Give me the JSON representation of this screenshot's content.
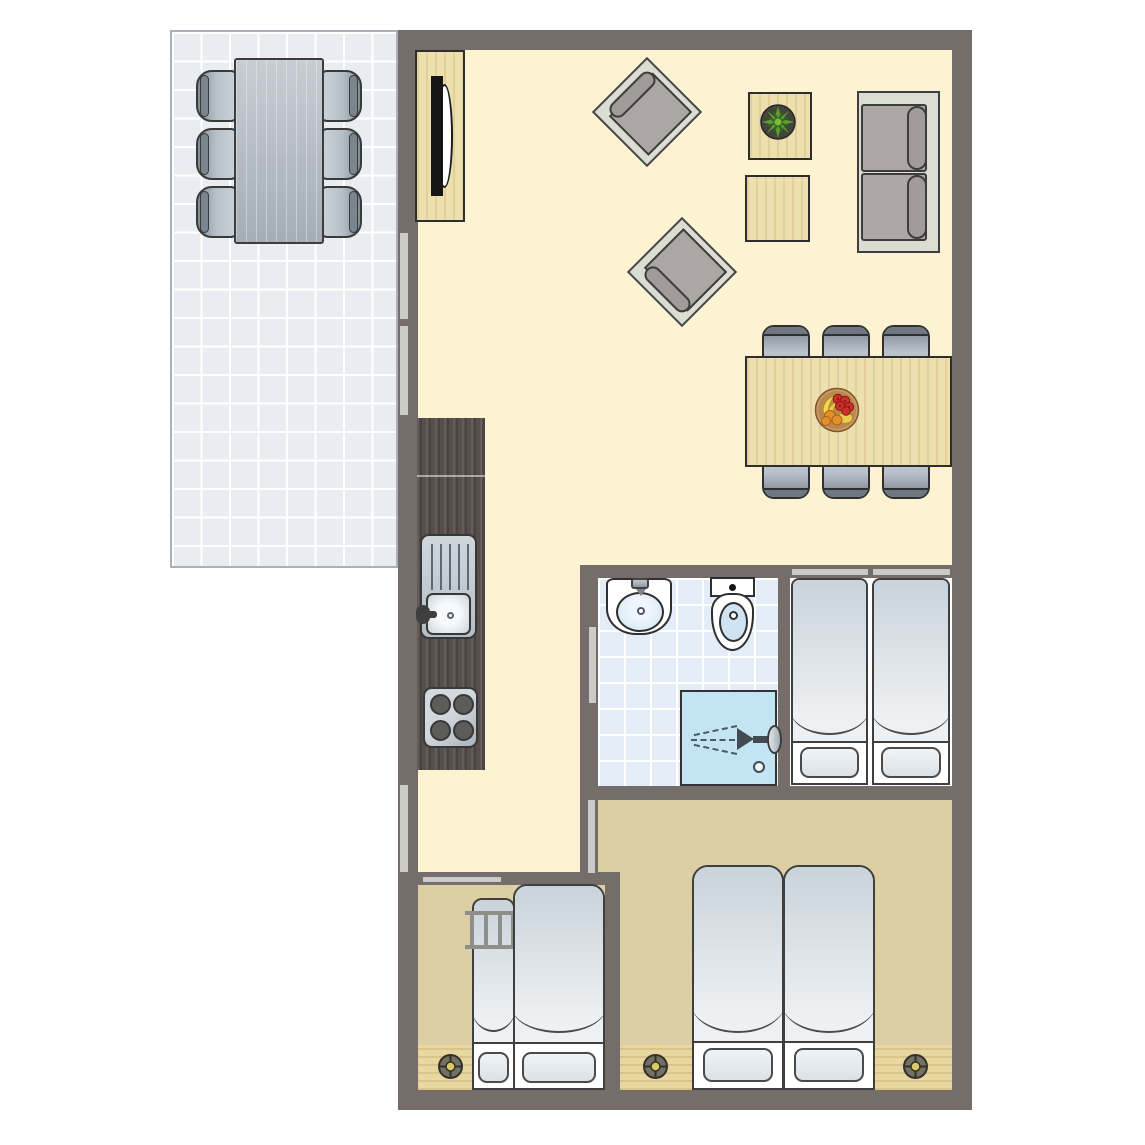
{
  "app": {
    "type": "floor-plan",
    "view": "top-down architectural plan of a holiday lodge with terrace"
  },
  "colors": {
    "wall": "#756d69",
    "floor_living": "#fdf2d2",
    "floor_tan": "#dccfa4",
    "floor_bathroom": "#e3ecf7",
    "floor_white": "#ffffff",
    "terrace_tile": "#e9edf2",
    "tile_line": "#ffffff",
    "wood": "#eedfae",
    "counter": "#564f4c",
    "furniture_frame": "#dcddd2",
    "cushion": "#aca7a5",
    "cushion_dark": "#a19b99",
    "bed_duvet_top": "#c9d3db",
    "bed_duvet_bottom": "#eef1f3",
    "shower": "#c3e5f3",
    "basin": "#cfe3f2",
    "window_strip": "#cbcbc9",
    "vent_ring": "#73715f",
    "vent_center": "#dbc968",
    "plant_leaf": "#5f9c30",
    "plant_leaf_dark": "#2f6b1d",
    "fruit_red": "#d32d28",
    "fruit_orange": "#e58f2b",
    "fruit_yellow": "#f4d44d",
    "bowl": "#c89a5f",
    "outline": "#2f2f2f"
  },
  "rooms": [
    {
      "name": "terrace",
      "furniture": [
        "outdoor-dining-table",
        "outdoor-chair x6"
      ],
      "floor": "tiles"
    },
    {
      "name": "living-dining-room",
      "furniture": [
        "tv-cabinet",
        "tv",
        "armchair x2",
        "side-table x2",
        "potted-plant",
        "sofa",
        "dining-table",
        "dining-chair x6",
        "fruit-bowl"
      ],
      "floor": "cream"
    },
    {
      "name": "kitchenette",
      "furniture": [
        "counter",
        "sink-with-drainboard",
        "stove-4-burners"
      ],
      "floor": "cream"
    },
    {
      "name": "bathroom",
      "furniture": [
        "washbasin",
        "toilet",
        "shower"
      ],
      "floor": "blue-tiles"
    },
    {
      "name": "twin-bedroom",
      "furniture": [
        "single-bed x2",
        "headboard x2"
      ],
      "floor": "white"
    },
    {
      "name": "double-bedroom",
      "furniture": [
        "single-bed x2",
        "ceiling-spot x2",
        "wood-sill x2"
      ],
      "floor": "tan"
    },
    {
      "name": "bunk-bedroom",
      "furniture": [
        "bunk-bed",
        "ladder",
        "ceiling-spot",
        "wood-sill"
      ],
      "floor": "tan"
    },
    {
      "name": "hallway",
      "furniture": [],
      "floor": "cream"
    }
  ],
  "openings": [
    "terrace-window x2",
    "rear-window",
    "bathroom-door",
    "twin-bedroom-door",
    "bunk-bedroom-door"
  ]
}
